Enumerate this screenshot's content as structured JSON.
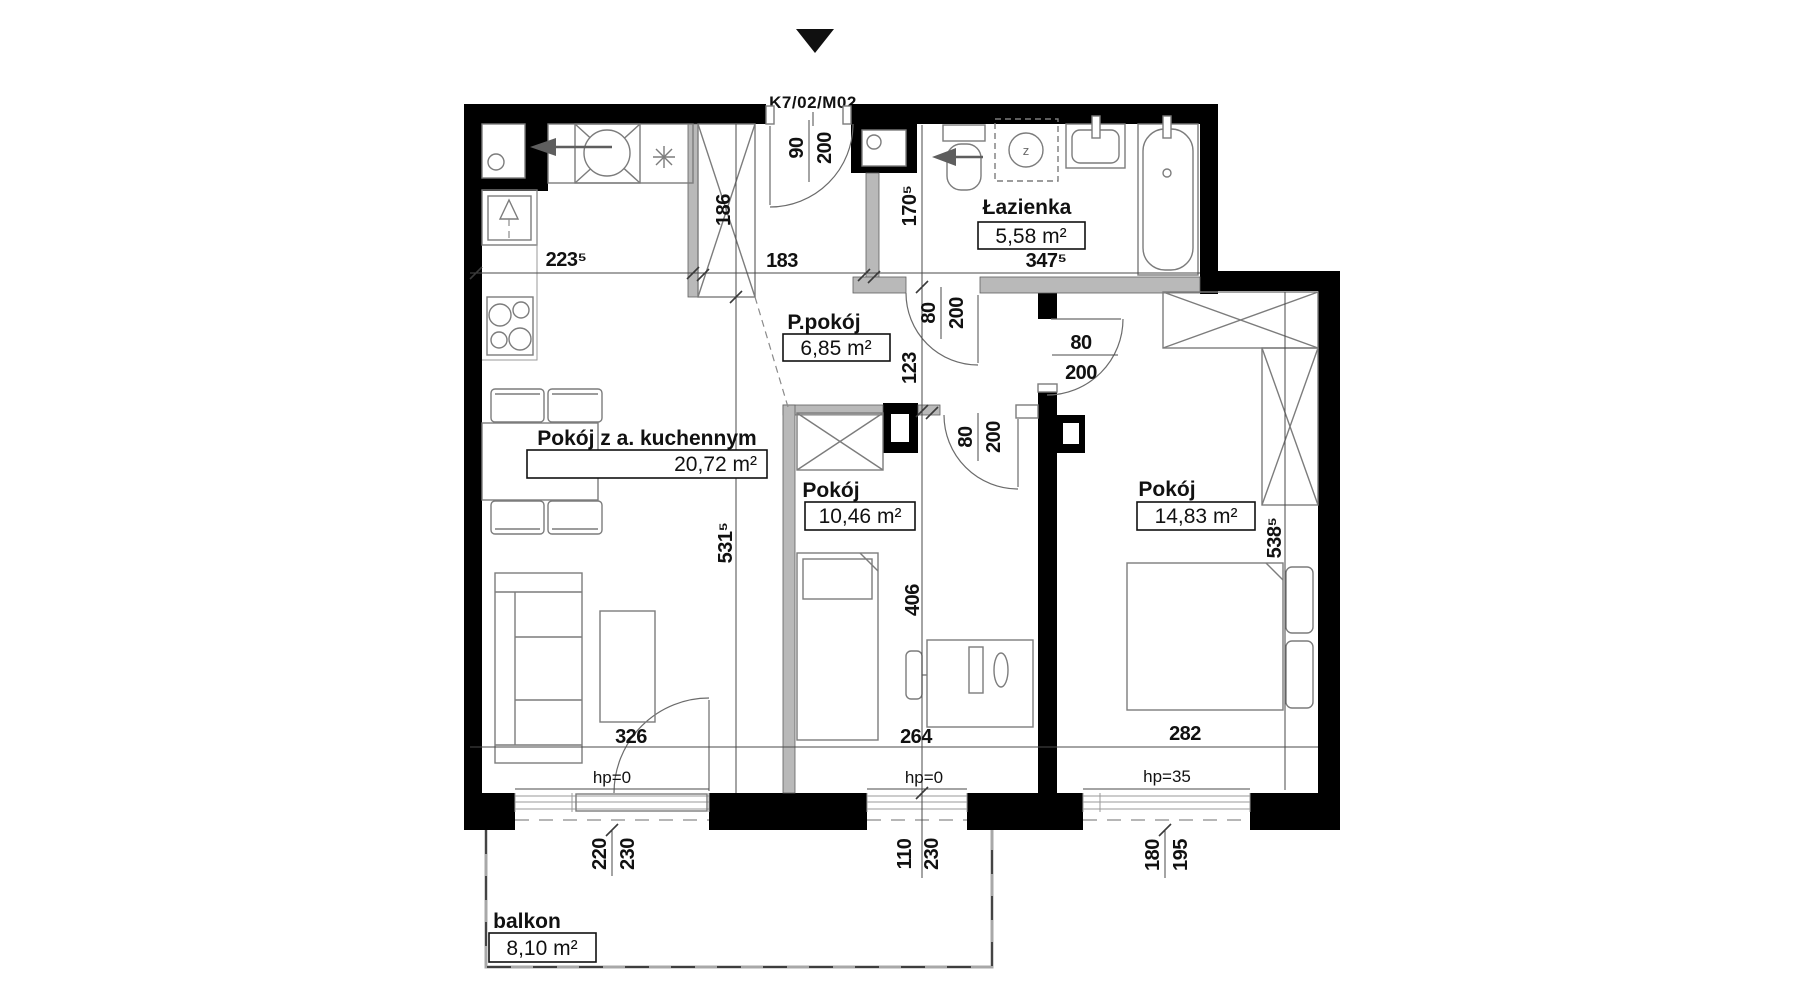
{
  "title": {
    "unit": "K7/02/M02"
  },
  "rooms": {
    "living": {
      "name": "Pokój z a. kuchennym",
      "area": "20,72 m²"
    },
    "hall": {
      "name": "P.pokój",
      "area": "6,85 m²"
    },
    "bath": {
      "name": "Łazienka",
      "area": "5,58 m²"
    },
    "bedroom_small": {
      "name": "Pokój",
      "area": "10,46 m²"
    },
    "bedroom_large": {
      "name": "Pokój",
      "area": "14,83 m²"
    },
    "balcony": {
      "name": "balkon",
      "area": "8,10 m²"
    }
  },
  "dims": {
    "kitchen_w": "223⁵",
    "hall_w": "183",
    "bath_w": "347⁵",
    "wardrobe_l": "186",
    "bath_h": "170⁵",
    "hall_h": "123",
    "bed_small_h": "406",
    "living_h": "531⁵",
    "bed_large_h": "538⁵",
    "living_w": "326",
    "bed_small_w": "264",
    "bed_large_w": "282"
  },
  "doors": {
    "entry_w": "90",
    "entry_h": "200",
    "bath_w": "80",
    "bath_h": "200",
    "small_w": "80",
    "small_h": "200",
    "large_w": "80",
    "large_h": "200"
  },
  "windows": {
    "living": {
      "w": "220",
      "h": "230",
      "hp": "hp=0"
    },
    "small": {
      "w": "110",
      "h": "230",
      "hp": "hp=0"
    },
    "large": {
      "w": "180",
      "h": "195",
      "hp": "hp=35"
    }
  },
  "symbols": {
    "washer": "z"
  }
}
